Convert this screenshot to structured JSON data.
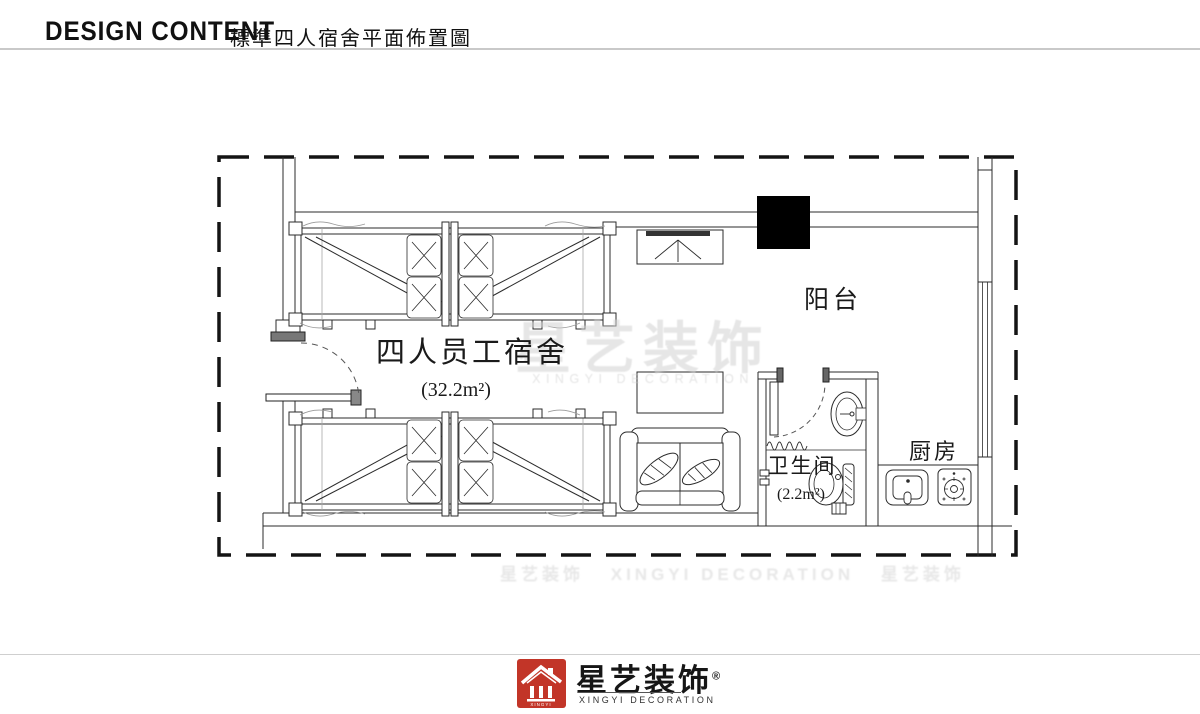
{
  "header": {
    "title_en": "DESIGN CONTENT",
    "title_zh": "標準四人宿舍平面佈置圖"
  },
  "rooms": {
    "dorm": {
      "label": "四人员工宿舍",
      "area": "(32.2m²)"
    },
    "balcony": {
      "label": "阳台"
    },
    "bathroom": {
      "label": "卫生间",
      "area": "(2.2m²)"
    },
    "kitchen": {
      "label": "厨房"
    }
  },
  "watermark": {
    "brand": "星艺装饰",
    "brand_en": "XINGYI DECORATION"
  },
  "footer": {
    "brand": "星艺装饰",
    "reg_mark": "®",
    "brand_en": "XINGYI DECORATION",
    "logo_text": "XINGYI"
  },
  "colors": {
    "line": "#2b2b2b",
    "column_fill": "#000000",
    "logo_red": "#c23528",
    "watermark_gray": "#d2d2d2"
  }
}
